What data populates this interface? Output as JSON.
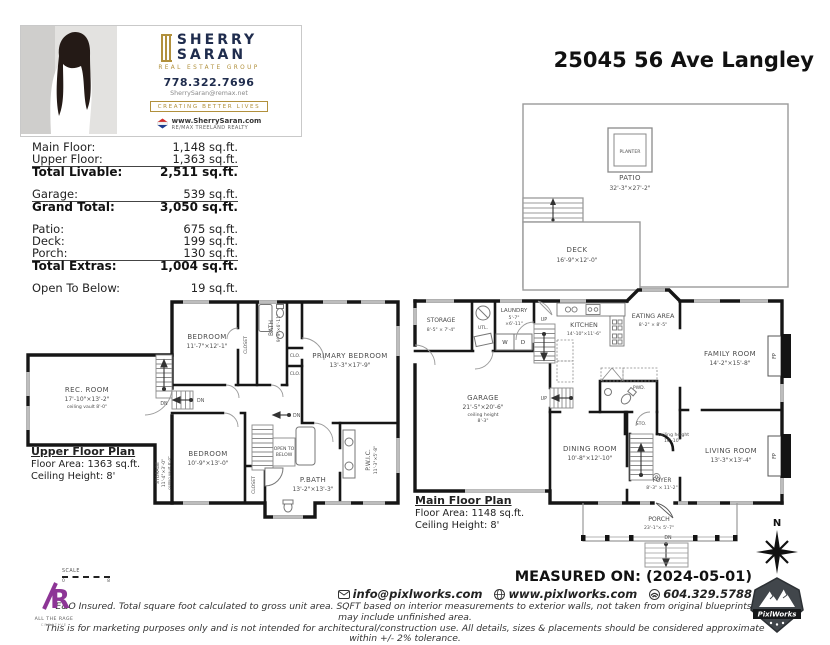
{
  "page": {
    "address": "25045 56 Ave Langley"
  },
  "branding": {
    "first_name": "SHERRY",
    "last_name": "SARAN",
    "group": "REAL ESTATE GROUP",
    "phone": "778.322.7696",
    "email": "SherrySaran@remax.net",
    "tagline": "CREATING BETTER LIVES",
    "website": "www.SherrySaran.com",
    "brokerage": "RE/MAX TREELAND REALTY"
  },
  "area_table": {
    "rows": [
      {
        "label": "Main Floor:",
        "value": "1,148 sq.ft."
      },
      {
        "label": "Upper Floor:",
        "value": "1,363 sq.ft."
      },
      {
        "label": "Total Livable:",
        "value": "2,511 sq.ft."
      },
      {
        "label": "Garage:",
        "value": "539 sq.ft."
      },
      {
        "label": "Grand Total:",
        "value": "3,050 sq.ft."
      },
      {
        "label": "Patio:",
        "value": "675 sq.ft."
      },
      {
        "label": "Deck:",
        "value": "199 sq.ft."
      },
      {
        "label": "Porch:",
        "value": "130 sq.ft."
      },
      {
        "label": "Total Extras:",
        "value": "1,004 sq.ft."
      },
      {
        "label": "Open To Below:",
        "value": "19 sq.ft."
      }
    ]
  },
  "outdoor": {
    "patio": {
      "name": "PATIO",
      "dims": "32'-3\"×27'-2\""
    },
    "planter": {
      "name": "PLANTER"
    },
    "deck": {
      "name": "DECK",
      "dims": "16'-9\"×12'-0\""
    }
  },
  "upper_plan": {
    "title": "Upper Floor Plan",
    "floor_area": "Floor Area: 1363 sq.ft.",
    "ceiling_height": "Ceiling Height: 8'",
    "rooms": {
      "rec_room": {
        "name": "REC. ROOM",
        "dims": "17'-10\"×13'-2\"",
        "note": "ceiling vault 8'-0\""
      },
      "bedroom_top": {
        "name": "BEDROOM",
        "dims": "11'-7\"×12'-1\""
      },
      "bath": {
        "name": "BATH",
        "dims": "9'-9\"×6'-11\""
      },
      "closet_top": {
        "name": "CLOSET"
      },
      "clo1": {
        "name": "CLO."
      },
      "clo2": {
        "name": "CLO."
      },
      "primary_bedroom": {
        "name": "PRIMARY BEDROOM",
        "dims": "13'-3\"×17'-9\""
      },
      "bedroom_bottom": {
        "name": "BEDROOM",
        "dims": "10'-9\"×13'-0\""
      },
      "storage": {
        "name": "STORAGE",
        "dims": "11'-4\"×3'-0\"",
        "note": "ceiling vault 8'-0\""
      },
      "open_to_below": {
        "line1": "OPEN TO",
        "line2": "BELOW"
      },
      "p_bath": {
        "name": "P.BATH",
        "dims": "13'-2\"×13'-3\""
      },
      "p_wic": {
        "name": "P.W.I.C.",
        "dims": "11'-3\"×5'-8\""
      },
      "closet_bottom": {
        "name": "CLOSET"
      }
    }
  },
  "main_plan": {
    "title": "Main Floor Plan",
    "floor_area": "Floor Area: 1148 sq.ft.",
    "ceiling_height": "Ceiling Height: 8'",
    "rooms": {
      "storage": {
        "name": "STORAGE",
        "dims": "8'-5\" × 7'-4\""
      },
      "utility": {
        "name": "UTL."
      },
      "laundry": {
        "name": "LAUNDRY",
        "dims": "5'-7\"",
        "dims2": "×6'-11\""
      },
      "washer": {
        "name": "W"
      },
      "dryer": {
        "name": "D"
      },
      "kitchen": {
        "name": "KITCHEN",
        "dims": "14'-10\"×11'-6\""
      },
      "eating_area": {
        "name": "EATING AREA",
        "dims": "8'-2\" × 8'-5\""
      },
      "family_room": {
        "name": "FAMILY ROOM",
        "dims": "14'-2\"×15'-8\""
      },
      "garage": {
        "name": "GARAGE",
        "dims": "21'-5\"×20'-6\"",
        "note1": "ceiling height",
        "note2": "8'-3\""
      },
      "powder": {
        "name": "PWD."
      },
      "sto": {
        "name": "STO."
      },
      "stair_note": {
        "line1": "ceiling height",
        "line2": "16'-10\""
      },
      "dining_room": {
        "name": "DINING ROOM",
        "dims": "10'-8\"×12'-10\""
      },
      "living_room": {
        "name": "LIVING ROOM",
        "dims": "13'-3\"×13'-4\""
      },
      "foyer": {
        "name": "FOYER",
        "dims": "8'-3\" × 11'-2\""
      },
      "porch": {
        "name": "PORCH",
        "dims": "23'-1\"× 5'-7\""
      },
      "fireplace": {
        "name": "FP"
      }
    }
  },
  "nav_labels": {
    "dn": "DN",
    "up": "UP",
    "north": "N"
  },
  "footer": {
    "measured_on": "MEASURED ON: (2024-05-01)",
    "email": "info@pixlworks.com",
    "website": "www.pixlworks.com",
    "phone": "604.329.5788",
    "disclaimer_line1": "E&O Insured.  Total square foot calculated to gross unit area. SQFT based on interior measurements to exterior walls, not taken from original blueprints, may include unfinished area.",
    "disclaimer_line2": "This is for marketing purposes only and is not intended for architectural/construction use.  All details, sizes & placements should be considered approximate within +/- 2% tolerance.",
    "scale_label": "SCALE",
    "scale_start": "0",
    "scale_end": "8",
    "creative_name": "ALL THE RAGE",
    "creative_sub": "CREATIVE",
    "pixlworks": "PixlWorks"
  }
}
